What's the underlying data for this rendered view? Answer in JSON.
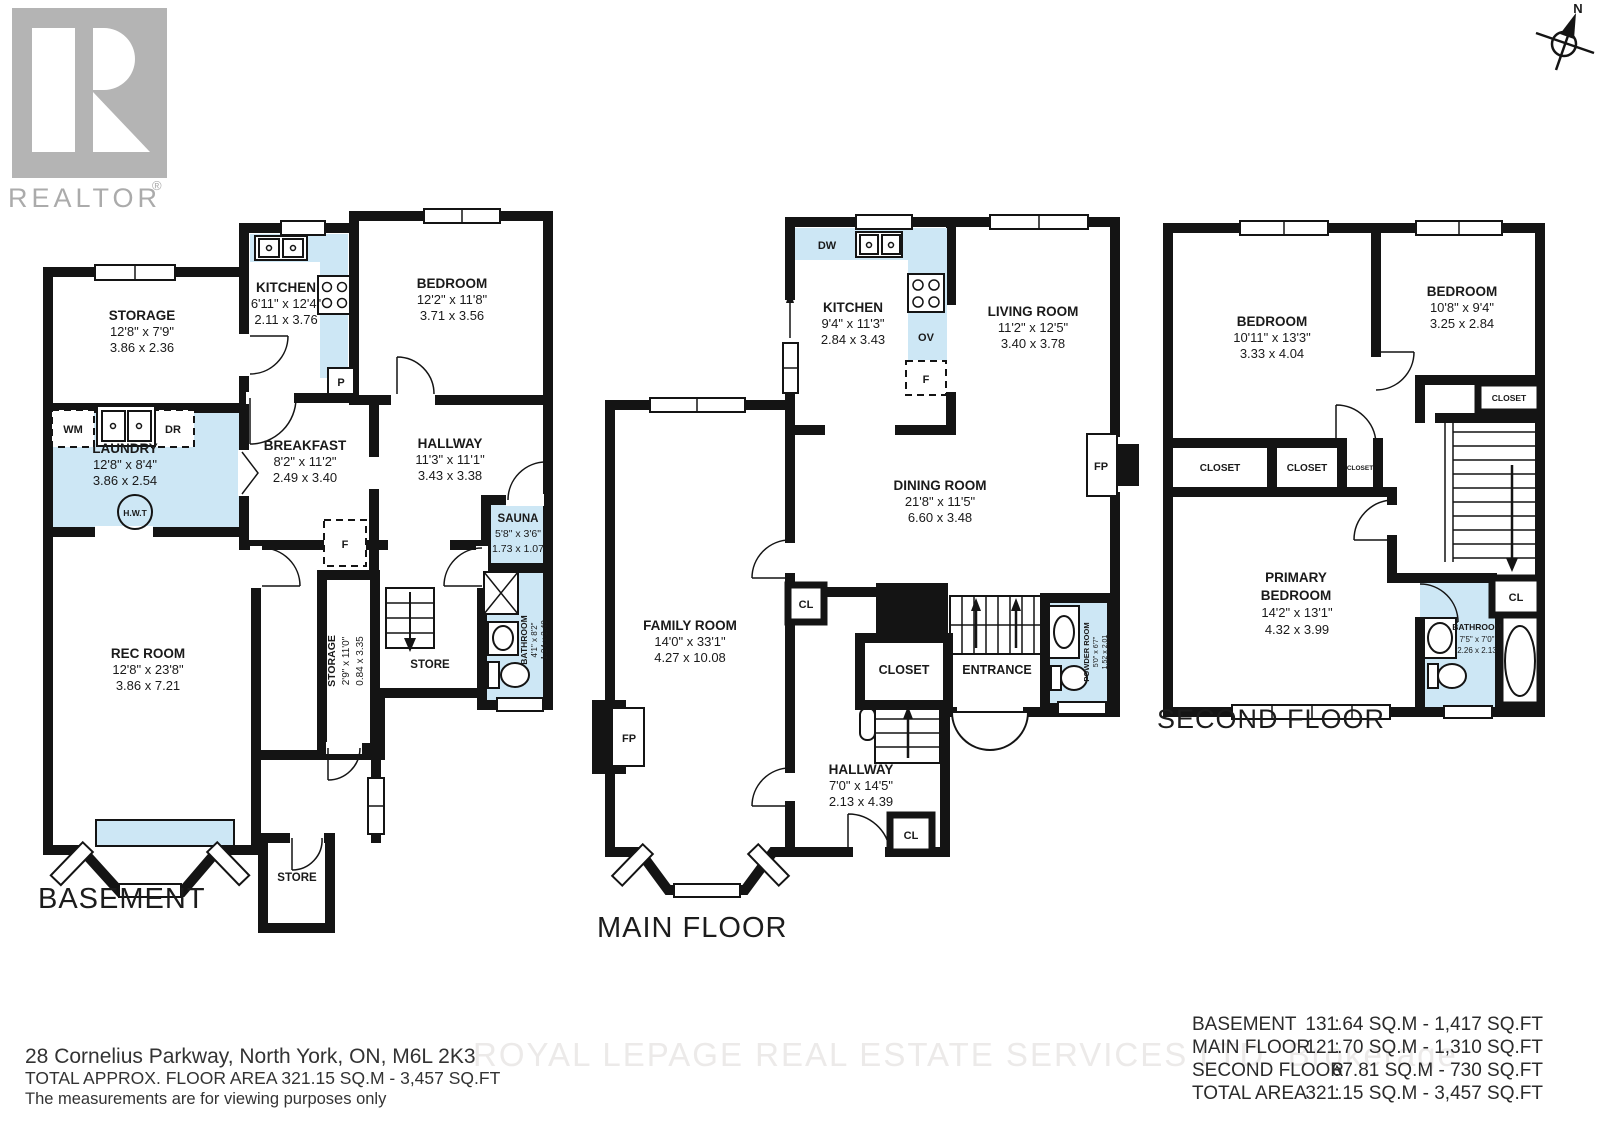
{
  "branding": {
    "logo_text": "REALTOR",
    "registered_mark": "®"
  },
  "compass": {
    "north": "N"
  },
  "floors": {
    "basement": {
      "title": "BASEMENT",
      "rooms": {
        "storage": {
          "name": "STORAGE",
          "imperial": "12'8\" x 7'9\"",
          "metric": "3.86 x 2.36"
        },
        "kitchen": {
          "name": "KITCHEN",
          "imperial": "6'11\" x 12'4\"",
          "metric": "2.11 x 3.76"
        },
        "bedroom": {
          "name": "BEDROOM",
          "imperial": "12'2\" x 11'8\"",
          "metric": "3.71 x 3.56"
        },
        "laundry": {
          "name": "LAUNDRY",
          "imperial": "12'8\" x 8'4\"",
          "metric": "3.86 x 2.54"
        },
        "breakfast": {
          "name": "BREAKFAST",
          "imperial": "8'2\" x 11'2\"",
          "metric": "2.49 x 3.40"
        },
        "hallway": {
          "name": "HALLWAY",
          "imperial": "11'3\" x 11'1\"",
          "metric": "3.43 x 3.38"
        },
        "sauna": {
          "name": "SAUNA",
          "imperial": "5'8\" x 3'6\"",
          "metric": "1.73 x 1.07"
        },
        "bathroom": {
          "name": "BATHROOM",
          "imperial": "4'1\" x 8'2\"",
          "metric": "1.24 x 2.49"
        },
        "storage_corridor": {
          "name": "STORAGE",
          "imperial": "2'9\" x 11'0\"",
          "metric": "0.84 x 3.35"
        },
        "rec_room": {
          "name": "REC ROOM",
          "imperial": "12'8\" x 23'8\"",
          "metric": "3.86 x 7.21"
        },
        "store_mid": {
          "name": "STORE"
        },
        "store_bottom": {
          "name": "STORE"
        }
      },
      "fixtures": {
        "washer": "WM",
        "dryer": "DR",
        "water_tank": "H.W.T",
        "pantry": "P",
        "furnace": "F"
      }
    },
    "main": {
      "title": "MAIN FLOOR",
      "rooms": {
        "kitchen": {
          "name": "KITCHEN",
          "imperial": "9'4\" x 11'3\"",
          "metric": "2.84 x 3.43"
        },
        "living": {
          "name": "LIVING ROOM",
          "imperial": "11'2\" x 12'5\"",
          "metric": "3.40 x 3.78"
        },
        "dining": {
          "name": "DINING ROOM",
          "imperial": "21'8\" x 11'5\"",
          "metric": "6.60 x 3.48"
        },
        "family": {
          "name": "FAMILY ROOM",
          "imperial": "14'0\" x 33'1\"",
          "metric": "4.27 x 10.08"
        },
        "hallway": {
          "name": "HALLWAY",
          "imperial": "7'0\" x 14'5\"",
          "metric": "2.13 x 4.39"
        },
        "powder": {
          "name": "POWDER ROOM",
          "imperial": "5'0\" x 6'7\"",
          "metric": "1.52 x 2.01"
        },
        "entrance": {
          "name": "ENTRANCE"
        },
        "closet": {
          "name": "CLOSET"
        },
        "closet_dining": {
          "name": "CL"
        },
        "closet_hall": {
          "name": "CL"
        }
      },
      "fixtures": {
        "dishwasher": "DW",
        "oven": "OV",
        "furnace": "F",
        "fireplace_right": "FP",
        "fireplace_left": "FP"
      }
    },
    "second": {
      "title": "SECOND FLOOR",
      "rooms": {
        "bedroom_left": {
          "name": "BEDROOM",
          "imperial": "10'11\" x 13'3\"",
          "metric": "3.33 x 4.04"
        },
        "bedroom_right": {
          "name": "BEDROOM",
          "imperial": "10'8\" x 9'4\"",
          "metric": "3.25 x 2.84"
        },
        "primary": {
          "name_line1": "PRIMARY",
          "name_line2": "BEDROOM",
          "imperial": "14'2\" x 13'1\"",
          "metric": "4.32 x 3.99"
        },
        "bathroom": {
          "name": "BATHROOM",
          "imperial": "7'5\" x 7'0\"",
          "metric": "2.26 x 2.13"
        },
        "closet_1": {
          "name": "CLOSET"
        },
        "closet_2": {
          "name": "CLOSET"
        },
        "closet_3": {
          "name": "CLOSET"
        },
        "closet_bedroom_right": {
          "name": "CLOSET"
        },
        "closet_landing": {
          "name": "CL"
        }
      }
    }
  },
  "footer": {
    "address": "28 Cornelius Parkway, North York, ON, M6L 2K3",
    "total_area_line": "TOTAL APPROX. FLOOR AREA 321.15 SQ.M - 3,457 SQ.FT",
    "disclaimer": "The measurements are for viewing purposes only",
    "watermark": "ROYAL LEPAGE REAL ESTATE SERVICES LTD.  Brokerage",
    "area_table": {
      "rows": [
        {
          "label": "BASEMENT",
          "colon": ":",
          "value": "131.64 SQ.M - 1,417 SQ.FT"
        },
        {
          "label": "MAIN FLOOR",
          "colon": ":",
          "value": "121.70 SQ.M - 1,310 SQ.FT"
        },
        {
          "label": "SECOND FLOOR",
          "colon": ":",
          "value": "67.81 SQ.M - 730 SQ.FT"
        },
        {
          "label": "TOTAL AREA",
          "colon": ":",
          "value": "321.15 SQ.M - 3,457 SQ.FT"
        }
      ]
    }
  }
}
